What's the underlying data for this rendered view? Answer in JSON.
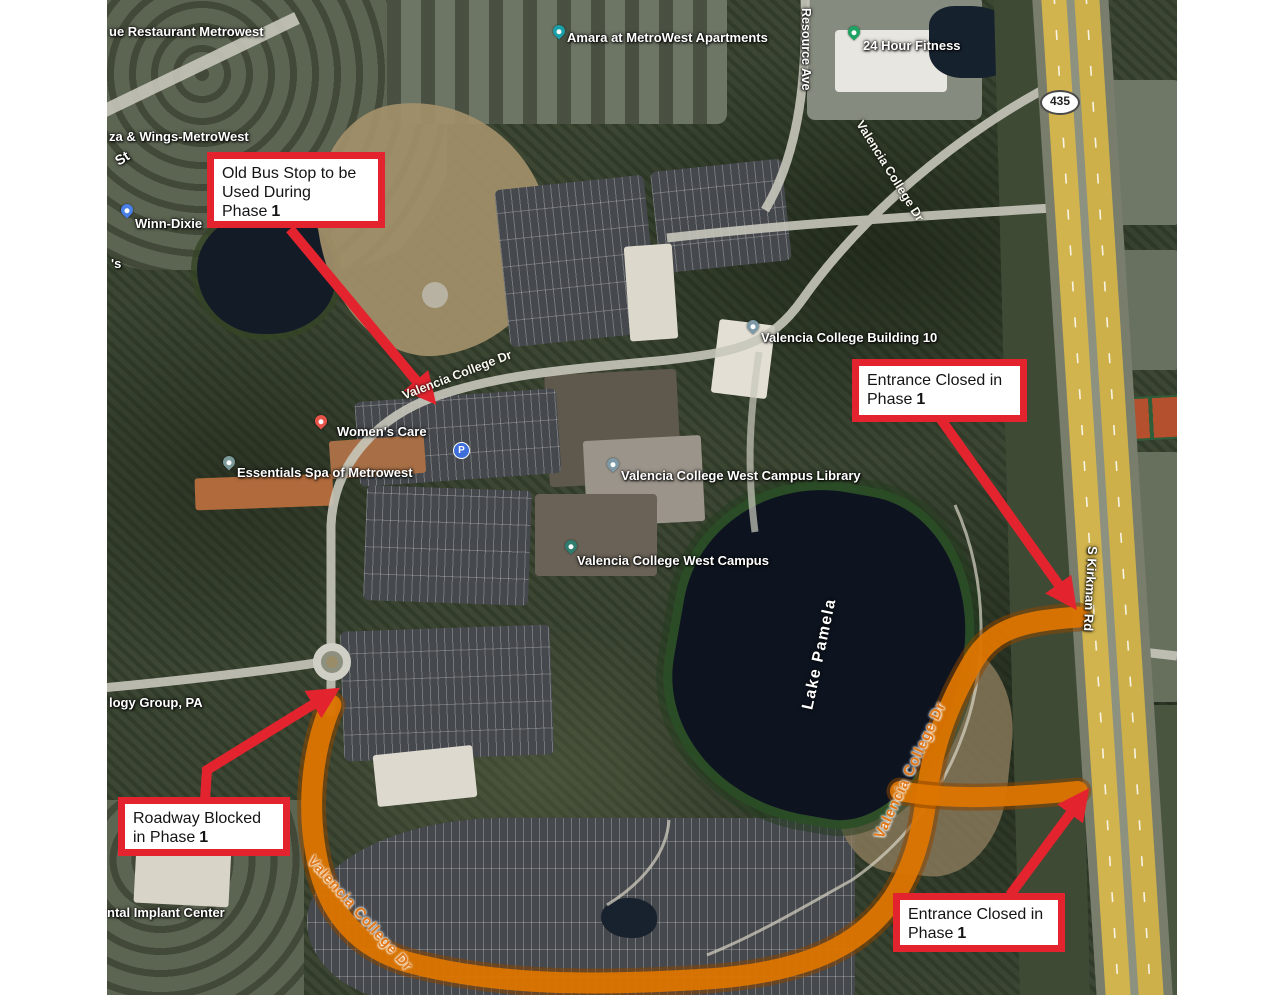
{
  "title": "Valencia College West Campus Phase 1 construction aerial map",
  "colors": {
    "callout_red": "#e3242e",
    "arrow_red": "#e3242e",
    "highlight_orange": "#e07000",
    "highway_yellow": "#d2b44e",
    "lake_water": "#0d1420",
    "background_white": "#ffffff"
  },
  "callouts": {
    "old_bus_stop": {
      "text": "Old Bus Stop to be Used During Phase",
      "number": "1"
    },
    "entrance_closed_top": {
      "text": "Entrance Closed in Phase",
      "number": "1"
    },
    "roadway_blocked": {
      "text": "Roadway Blocked in Phase",
      "number": "1"
    },
    "entrance_closed_bottom": {
      "text": "Entrance Closed in Phase",
      "number": "1"
    }
  },
  "map_labels": {
    "restaurant_metrowest": "ue Restaurant Metrowest",
    "street_st": "St",
    "pizza_wings": "za & Wings-MetroWest",
    "winn_dixie": "Winn-Dixie",
    "partial_s": "'s",
    "amara_apartments": "Amara at MetroWest Apartments",
    "resource_ave": "Resource Ave",
    "fitness_24": "24 Hour Fitness",
    "route_435": "435",
    "valencia_college_dr": "Valencia College Dr",
    "building_10": "Valencia College Building 10",
    "library": "Valencia College West Campus Library",
    "west_campus": "Valencia College West Campus",
    "womens_care": "Women's Care",
    "essentials_spa": "Essentials Spa of Metrowest",
    "lake_pamela": "Lake Pamela",
    "s_kirkman_rd": "S Kirkman Rd",
    "group_pa": "logy Group, PA",
    "implant_center": "ntal Implant Center",
    "parking_p": "P"
  }
}
